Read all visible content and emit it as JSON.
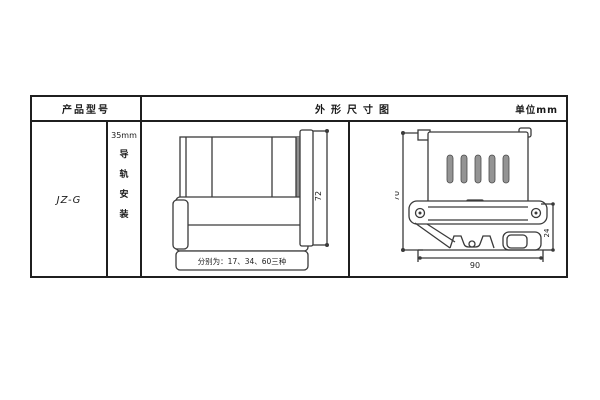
{
  "page": {
    "background": "#ffffff",
    "line_color": "#333333",
    "slot_fill": "#949494",
    "shade_fill": "#8f8f8f"
  },
  "table": {
    "header": {
      "product_col": "产品型号",
      "drawing_col": "外形尺寸图",
      "unit": "单位mm"
    },
    "product_model": "JZ-G",
    "mounting": {
      "rail_size": "35mm",
      "label": "导轨安装",
      "label_chars": [
        "导",
        "轨",
        "安",
        "装"
      ]
    }
  },
  "front_view": {
    "height_dim": "72",
    "caption": "分别为：17、34、60三种"
  },
  "side_view": {
    "height_dim": "70",
    "width_dim": "90",
    "clip_dim": "24"
  }
}
